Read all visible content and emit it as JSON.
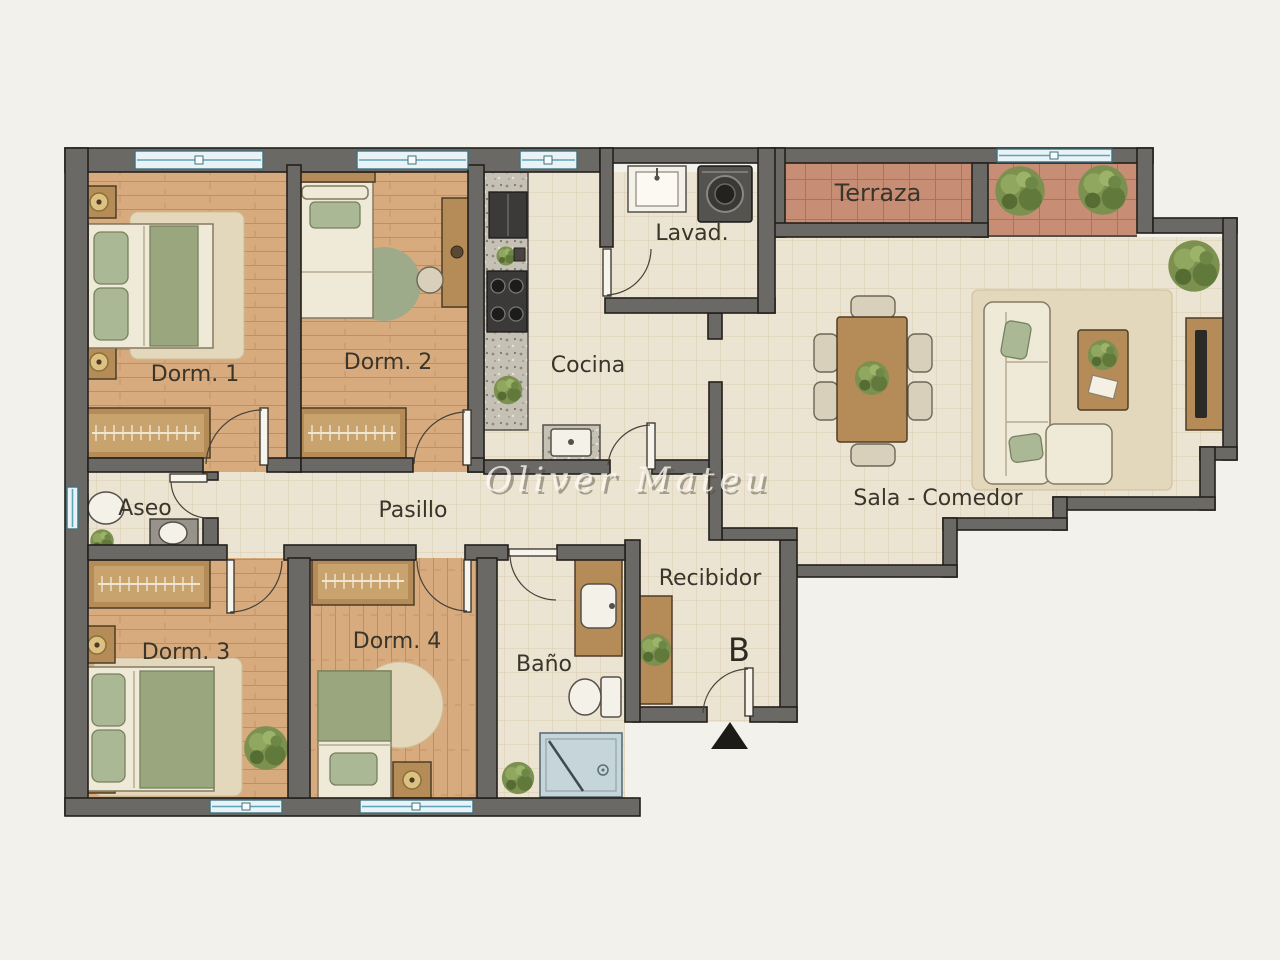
{
  "plan": {
    "watermark": "Oliver Mateu",
    "entrance_marker": "B",
    "rooms": {
      "dorm1": "Dorm. 1",
      "dorm2": "Dorm. 2",
      "cocina": "Cocina",
      "lavadero": "Lavad.",
      "terraza": "Terraza",
      "sala_comedor": "Sala - Comedor",
      "aseo": "Aseo",
      "pasillo": "Pasillo",
      "dorm3": "Dorm. 3",
      "dorm4": "Dorm. 4",
      "bano": "Baño",
      "recibidor": "Recibidor"
    },
    "colors": {
      "paper": "#f3f1ec",
      "wall": "#6b6965",
      "wood_floor": "#d7ab7e",
      "tile_floor": "#ece4d2",
      "terrace_floor": "#c78e75",
      "window_blue": "#5fa3ba",
      "plant_green": "#7c9150",
      "fabric_green": "#9aa77e"
    }
  }
}
